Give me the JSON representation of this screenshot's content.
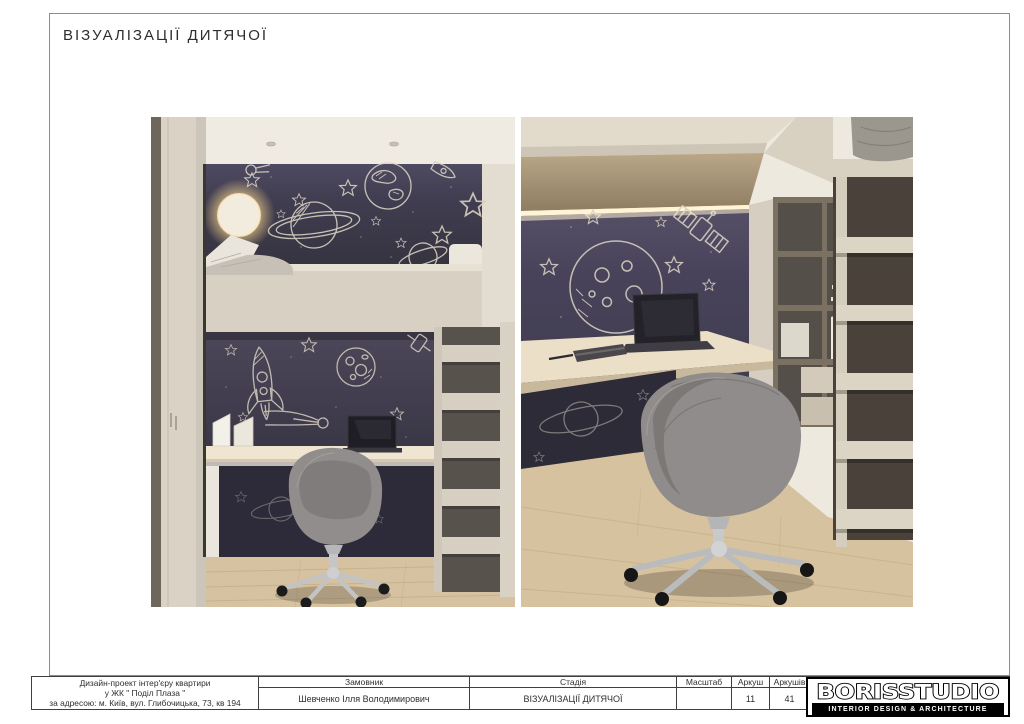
{
  "page": {
    "title": "ВІЗУАЛІЗАЦІЇ ДИТЯЧОЇ"
  },
  "renders": {
    "left": {
      "name": "kids-room-loft-bed-overview"
    },
    "right": {
      "name": "kids-room-desk-closeup"
    },
    "palette": {
      "wallpaper_navy": "#3e3a4b",
      "chalk_line": "#d8d0c2",
      "furniture_cream": "#d8d1c3",
      "soffit_tan": "#ab9878",
      "desk_wood": "#ecdfc8",
      "floor_wood": "#d5c19e",
      "chair_grey": "#8f8c8b",
      "laptop_dark": "#232229",
      "lamp_glow": "#f8e7bb"
    }
  },
  "title_block": {
    "project": {
      "line1": "Дизайн-проект інтер'єру квартири",
      "line2": "у ЖК \" Поділ Плаза \"",
      "line3": "за адресою: м. Київ, вул. Глибочицька, 73, кв 194"
    },
    "client": {
      "label": "Замовник",
      "value": "Шевченко Ілля Володимирович"
    },
    "stage": {
      "label": "Стадія",
      "value": "ВІЗУАЛІЗАЦІЇ ДИТЯЧОЇ"
    },
    "scale": {
      "label": "Масштаб",
      "value": ""
    },
    "sheet": {
      "label": "Аркуш",
      "value": "11"
    },
    "sheets": {
      "label": "Аркушів",
      "value": "41"
    },
    "logo": {
      "name": "BORISSTUDIO",
      "tagline": "INTERIOR DESIGN & ARCHITECTURE"
    }
  }
}
